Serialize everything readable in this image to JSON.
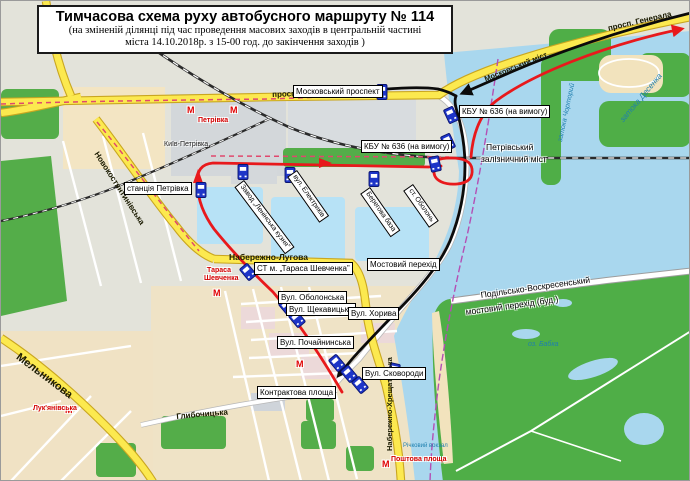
{
  "title": {
    "line1": "Тимчасова схема руху автобусного маршруту  № 114",
    "line2": "(на зміненій ділянці під час  проведення масових заходів в центральній частині",
    "line3": "міста  14.10.2018р. з 15-00 год. до закінчення заходів )"
  },
  "colors": {
    "route_temporary_red": "#e8191c",
    "route_main_black": "#0b0b0b",
    "cancelled_dashed_pink": "#e0486e",
    "major_road_yellow": "#fce94f",
    "water_blue": "#a9d7ee",
    "park_green": "#54ad49",
    "boundary_purple": "#b44fb4",
    "bus_stop_blue": "#1e35c8"
  },
  "stops": {
    "moskovskyi_prospekt": "Московський проспект",
    "kbu_636_a": "КБУ № 636 (на вимогу)",
    "kbu_636_b": "КБУ № 636 (на вимогу)",
    "st_m_tarasa_shevchenka": "СТ м. „Тараса Шевченка”",
    "vul_obolonska": "Вул. Оболонська",
    "vul_shchekavytska": "Вул. Щекавицька",
    "vul_pochayninska": "Вул. Почайнинська",
    "vul_khoryva": "Вул. Хорива",
    "vul_skovorody": "Вул. Сковороди",
    "kontraktova_ploshcha": "Контрактова площа",
    "mostovyi_perekhid": "Мостовий перехід"
  },
  "roads": {
    "prosp_moskovskyi": "просп. Московський",
    "prosp_henerala": "просп. Генерала",
    "moskovskyi_mist": "Московський міст",
    "naberezhno_luhova": "Набережно-Лугова",
    "naberezhno_khreshchatytska": "Набережно-Хрещатицька",
    "novokostiantynivska": "Новокостянтинівська",
    "melnykova": "Мельникова",
    "hlybochytska": "Глибочицька",
    "vul_elektrykiv": "вул. Електриків",
    "berehova_baza": "Берегова база",
    "st_obolon": "ст. Оболонь",
    "zavod_leninska_kuznia": "Завод „Ленінська кузня”"
  },
  "bridges": {
    "petrivskyi_1": "Петрівський",
    "petrivskyi_2": "залізничний міст",
    "podilsko_voskresenskyi_1": "Подільсько-Воскресенський",
    "podilsko_voskresenskyi_2": "мостовий перехід (буд.)"
  },
  "stations": {
    "stantsiia_petrivka": "станція Петрівка",
    "kyiv_petrivka": "Київ-Петрівка"
  },
  "metro": {
    "letter": "М",
    "petrivka": "Петрівка",
    "tarasa_shevchenka_1": "Тараса",
    "tarasa_shevchenka_2": "Шевченка",
    "lukianivska": "Лук'янівська",
    "poshtova_ploshcha": "Поштова площа"
  },
  "water": {
    "zatoka_desenka": "затока Десенка",
    "zatoka_chortoryi": "затока Чорторий",
    "oz_babka": "оз. Бабка",
    "richkovyi_vokzal": "Річковий вокзал"
  }
}
